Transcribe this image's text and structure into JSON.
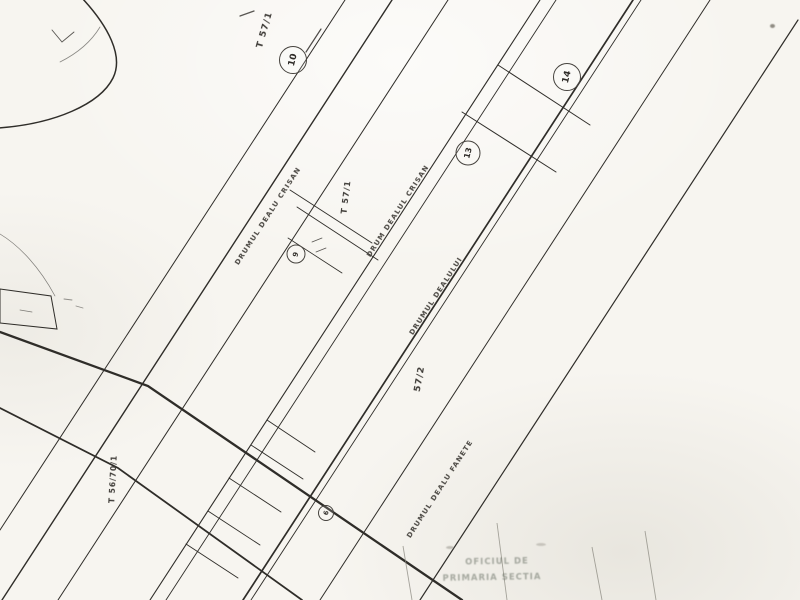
{
  "map": {
    "palette": {
      "background": "#f7f5f0",
      "line": "#2f2d29",
      "faint_line": "#8a887f",
      "text": "#3d3a36",
      "stamp_text": "#5c6458"
    },
    "tract_labels": {
      "top": "T 57/1",
      "middle": "T 57/1",
      "parcel_center": "57/2",
      "left": "T 56/70/1"
    },
    "road_labels": [
      {
        "name": "DRUMUL DEALU CRISAN"
      },
      {
        "name": "DRUM DEALUL CRISAN"
      },
      {
        "name": "DRUMUL DEALULUI"
      },
      {
        "name": "DRUMUL DEALU FANETE"
      }
    ],
    "parcel_markers": [
      {
        "number": "10"
      },
      {
        "number": "9"
      },
      {
        "number": "13"
      },
      {
        "number": "14"
      },
      {
        "number": "6"
      }
    ],
    "stamp": {
      "line1": "OFICIUL DE",
      "line2": "PRIMARIA SECTIA"
    }
  }
}
